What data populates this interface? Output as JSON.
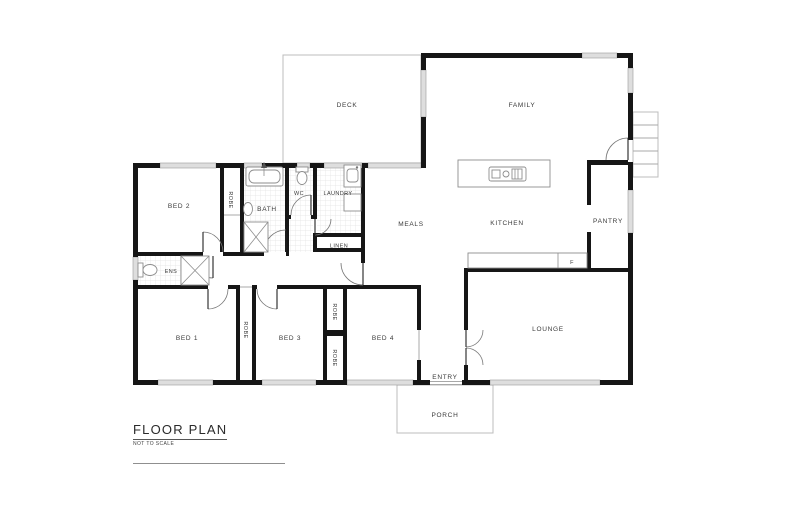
{
  "title_block": {
    "title": "FLOOR PLAN",
    "subtitle": "NOT TO SCALE"
  },
  "rooms": {
    "deck": "DECK",
    "family": "FAMILY",
    "bed2": "BED 2",
    "robe_bed2": "ROBE",
    "bath": "BATH",
    "wc": "WC",
    "laundry": "LAUNDRY",
    "meals": "MEALS",
    "kitchen": "KITCHEN",
    "pantry": "PANTRY",
    "linen": "LINEN",
    "ens": "ENS",
    "bed1": "BED 1",
    "robe_bed1": "ROBE",
    "bed3": "BED 3",
    "robe_bed3_top": "ROBE",
    "robe_bed3_bottom": "ROBE",
    "bed4": "BED 4",
    "lounge": "LOUNGE",
    "entry": "ENTRY",
    "porch": "PORCH"
  },
  "fixtures": {
    "fridge": "F"
  },
  "colors": {
    "walls": "#161616",
    "windows": "#dedede",
    "outlines": "#bcbcbc",
    "text": "#3a3a3a"
  }
}
